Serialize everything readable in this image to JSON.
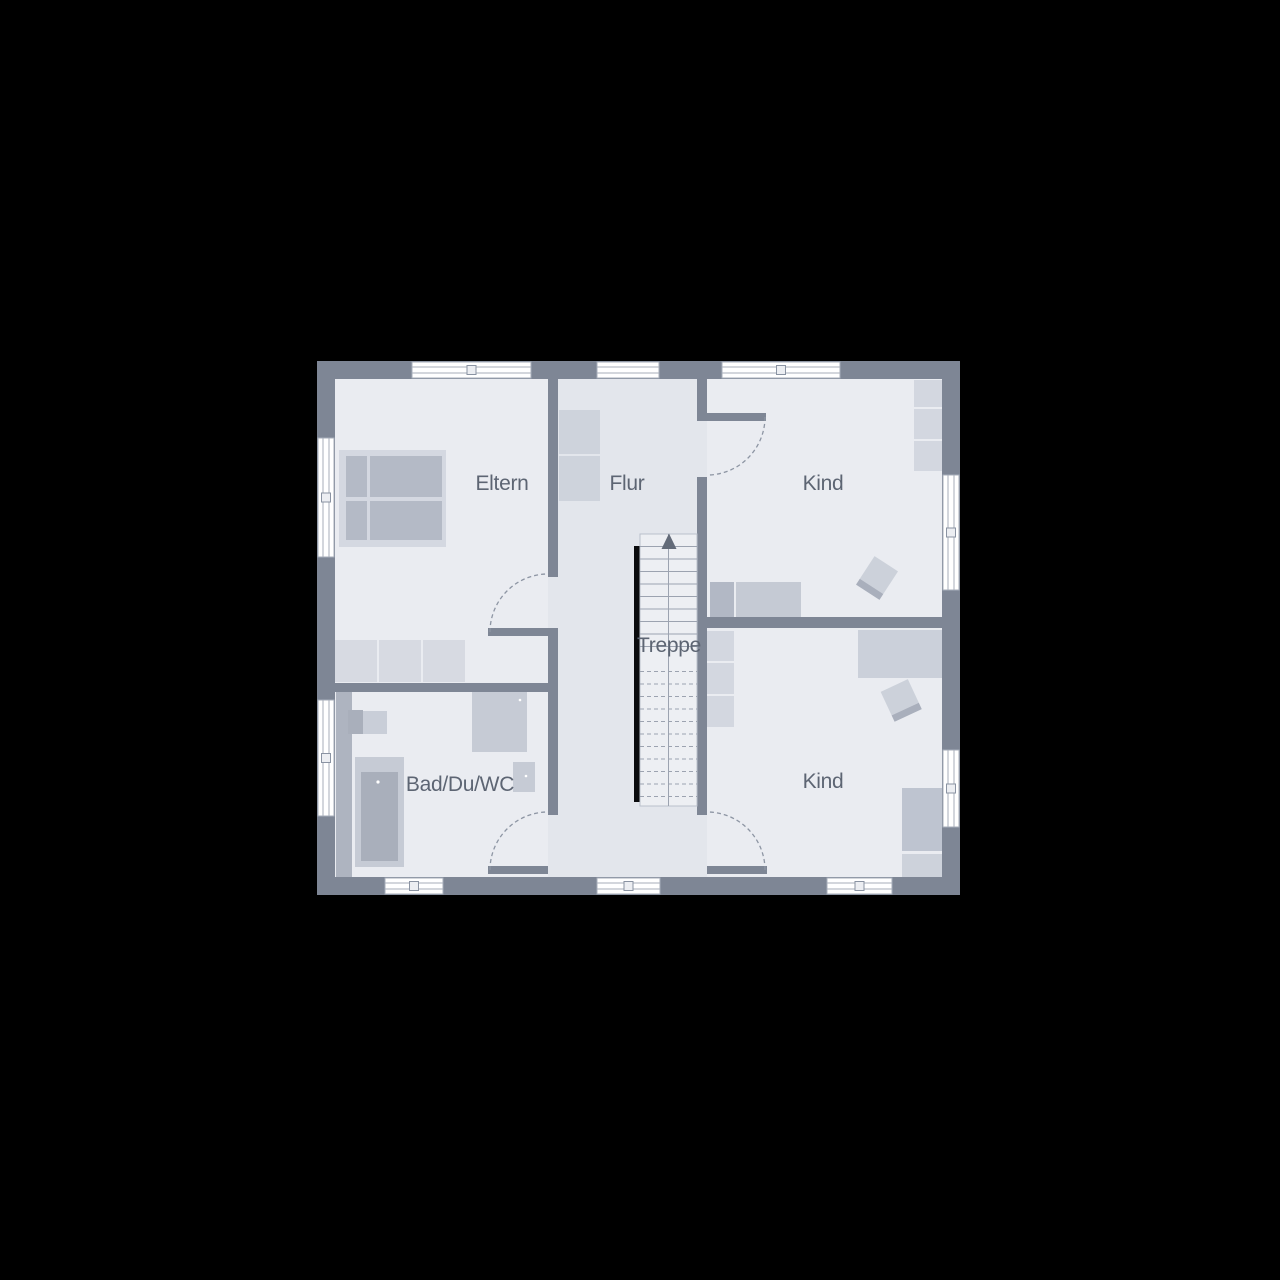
{
  "floor_plan": {
    "type": "house-upper-floor-plan",
    "colors": {
      "background": "#000000",
      "wall": "#7e8695",
      "room_floor": "#eaecf1",
      "corridor_floor": "#e3e6ec",
      "stair_floor": "#edeff3",
      "furniture_light": "#d3d7e0",
      "furniture_mid": "#c6cbd5",
      "furniture_dark": "#a9afbb",
      "window_fill": "#ffffff",
      "label_text": "#5d6573",
      "stair_rail": "#0a0b0d"
    },
    "rooms": [
      {
        "id": "eltern",
        "label": "Eltern"
      },
      {
        "id": "flur",
        "label": "Flur"
      },
      {
        "id": "kind_top",
        "label": "Kind"
      },
      {
        "id": "treppe",
        "label": "Treppe"
      },
      {
        "id": "bad",
        "label": "Bad/Du/WC"
      },
      {
        "id": "kind_bottom",
        "label": "Kind"
      }
    ],
    "stair_direction_arrow": "up",
    "window_count": {
      "top": 3,
      "bottom": 3,
      "left": 2,
      "right": 2
    },
    "door_count": 4
  }
}
